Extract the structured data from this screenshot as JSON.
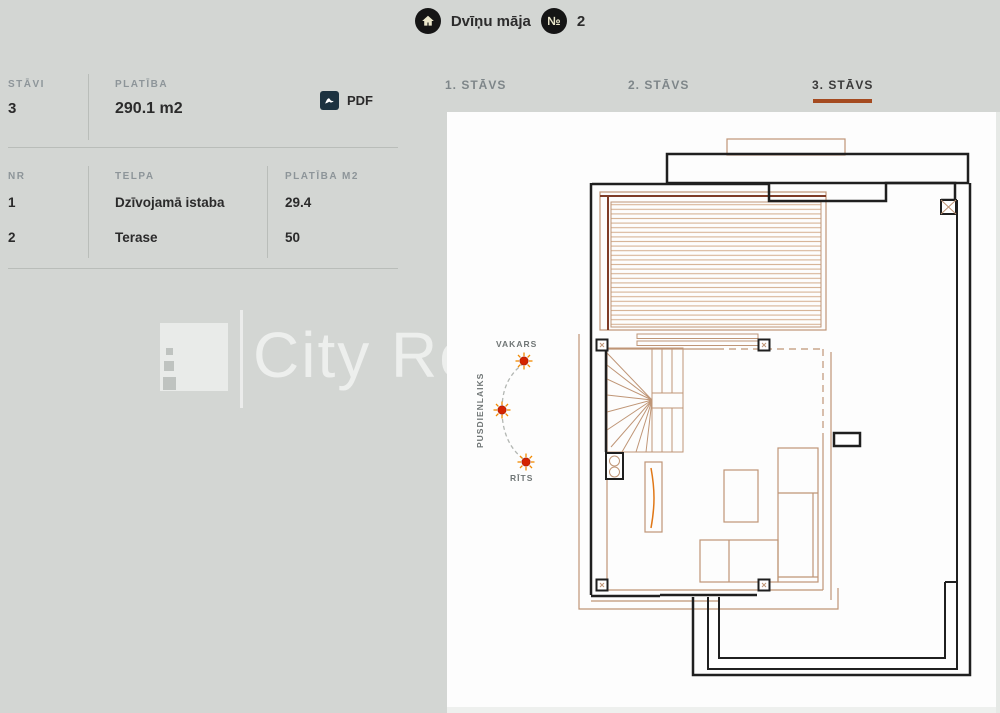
{
  "header": {
    "title": "Dvīņu māja",
    "number_symbol": "№",
    "number_value": "2"
  },
  "summary": {
    "floors_label": "STĀVI",
    "floors_value": "3",
    "area_label": "PLATĪBA",
    "area_value": "290.1 m2",
    "pdf_label": "PDF"
  },
  "rooms_table": {
    "headers": [
      "NR",
      "TELPA",
      "PLATĪBA M2"
    ],
    "rows": [
      {
        "nr": "1",
        "telpa": "Dzīvojamā istaba",
        "platiba": "29.4"
      },
      {
        "nr": "2",
        "telpa": "Terase",
        "platiba": "50"
      }
    ]
  },
  "tabs": [
    {
      "label": "1. STĀVS"
    },
    {
      "label": "2. STĀVS"
    },
    {
      "label": "3. STĀVS"
    }
  ],
  "active_tab": "3. STĀVS",
  "watermark": {
    "text": "City Re"
  },
  "compass": {
    "evening": "VAKARS",
    "noon": "PUSDIENLAIKS",
    "morning": "RĪTS"
  },
  "colors": {
    "background": "#d3d6d3",
    "accent_underline": "#a54b20",
    "plan_tan": "#bf9576",
    "plan_hatch": "#d6b294",
    "plan_dark_red": "#7e3c28",
    "plan_black": "#1f1f1f",
    "cabinet_orange": "#e07818",
    "sun_red": "#d42300",
    "sun_ray_orange": "#f28a00",
    "badge_bg": "#151515",
    "badge_fg": "#ece8cc",
    "pdf_icon_bg": "#1c3240"
  }
}
